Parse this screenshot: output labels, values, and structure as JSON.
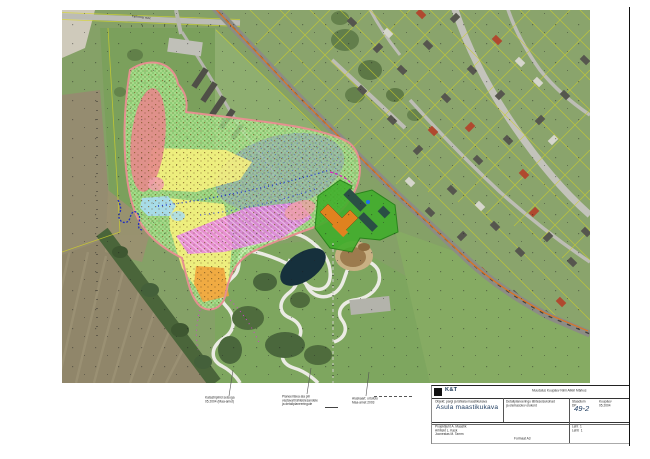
{
  "page": {
    "sheet_number": "49-2"
  },
  "map": {
    "road_label": "Tallinna mnt"
  },
  "annotations": {
    "blocks": [
      {
        "lines": [
          "Katastripiirid seisuga",
          "05.2004 (Maa-amet)"
        ]
      },
      {
        "lines": [
          "Planeeritava ala piir",
          "vastavalt lähteülesandele",
          "ja detailplaneeringule"
        ]
      },
      {
        "lines": [
          "Aluskaart: ortofoto",
          "Maa-amet 2003"
        ]
      }
    ]
  },
  "title_block": {
    "company_name": "K&T",
    "revision_header": "Muudatus  Kuupäev  Nimi  Allkiri  Märkus",
    "object_line": "Objekt: pargi ja lähiala maastikukava",
    "title": "Asula maastikukava",
    "middle_line_1": "Detailplaneeringu lähteseisukohad",
    "middle_line_2": "ja olemasolev olukord",
    "stage_label": "Staadium",
    "stage_value": "DP",
    "date_label": "Kuupäev",
    "date_value": "05.2004",
    "sheet_number": "49-2",
    "crew_line_1": "Projektijuht  A. Maastik",
    "crew_line_2": "Arhitekt  L. Kask",
    "crew_line_3": "Joonestas  M. Tamm",
    "sheet_label": "Leht",
    "sheet_value": "1",
    "sheets_label": "Lehti",
    "sheets_value": "1",
    "footer_note": "Formaat A3"
  },
  "colors": {
    "plume_green": "#b9ee9b",
    "plume_dot_green": "#2f9e2f",
    "zone_red": "#e58b8b",
    "zone_pink": "#efa0a8",
    "zone_yellow": "#fbf27e",
    "zone_magenta": "#e678e6",
    "zone_cyan": "#a8dcf0",
    "zone_gray": "#8fa6ba",
    "zone_orange": "#f0a33c",
    "outline_salmon": "#e59090",
    "site_green": "#3fae2a",
    "building_orange": "#e0821f",
    "building_teal": "#2a4f45",
    "boundary_orange": "#e0731c",
    "pond_dark": "#16303c",
    "accent_navy": "#1c3a5e"
  }
}
